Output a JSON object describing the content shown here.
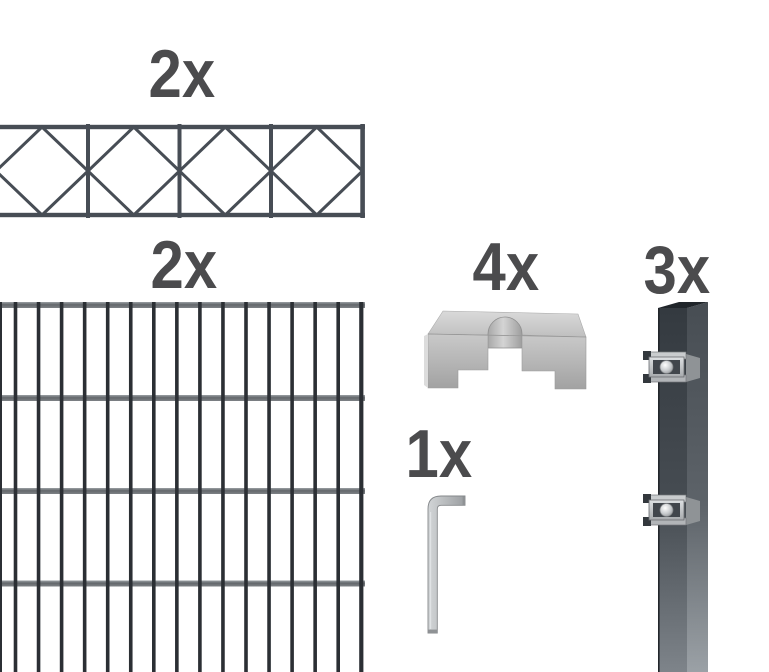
{
  "canvas": {
    "width": 769,
    "height": 672,
    "background": "#ffffff"
  },
  "items": [
    {
      "id": "ornamental-panel",
      "name": "ornamental fence panel with diamond cross pattern",
      "qty_label": "2x"
    },
    {
      "id": "double-rod-panel",
      "name": "double-rod grid fence panel",
      "qty_label": "2x"
    },
    {
      "id": "cover-bracket",
      "name": "galvanized metal cover bracket",
      "qty_label": "4x"
    },
    {
      "id": "allen-key",
      "name": "allen hex key",
      "qty_label": "1x"
    },
    {
      "id": "fence-post",
      "name": "anthracite fence post with two clamps",
      "qty_label": "3x"
    }
  ],
  "colors": {
    "background": "#ffffff",
    "label_text": "#4b4b4d",
    "panel_wire": "#474d55",
    "panel_bar": "#2b2f34",
    "anthracite": "#353b42",
    "galvanized_light": "#cdd0d2",
    "galvanized_dark": "#9aa0a5"
  }
}
